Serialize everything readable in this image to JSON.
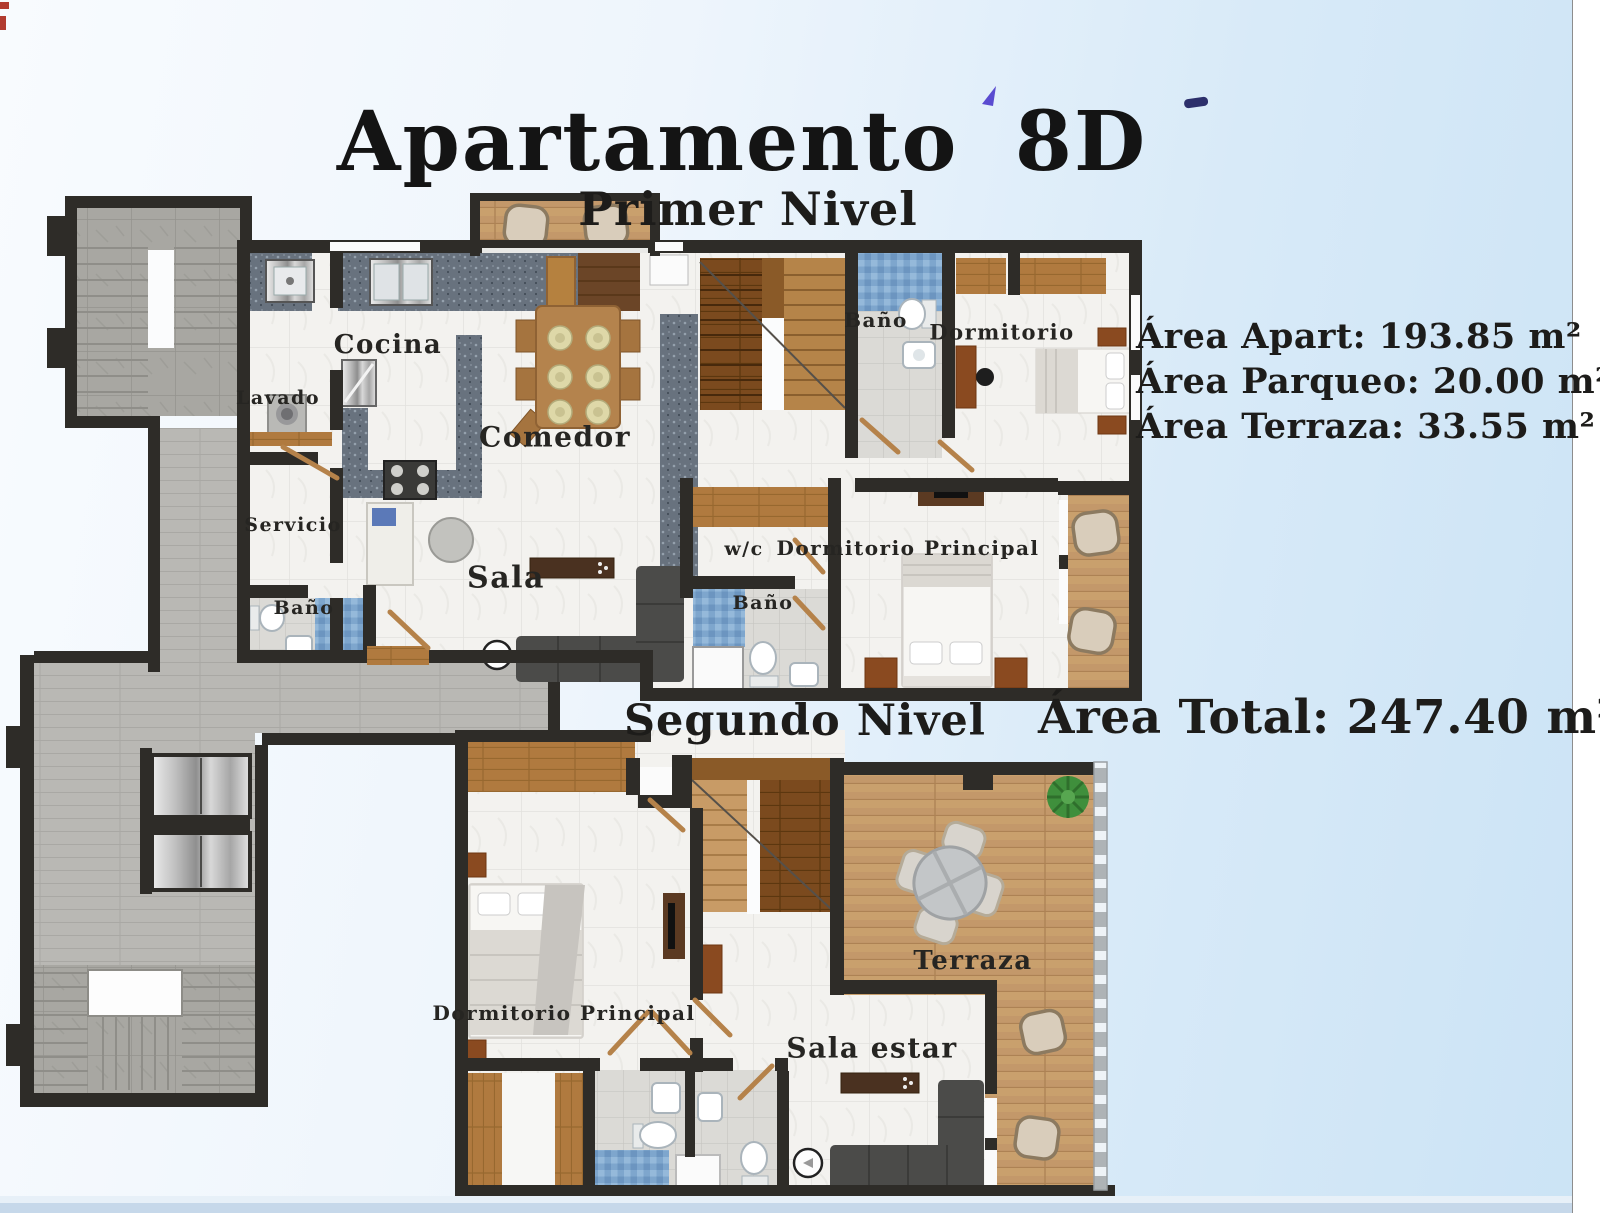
{
  "title": "Apartamento 8D",
  "level1": {
    "heading": "Primer Nivel",
    "rooms": {
      "cocina": "Cocina",
      "lavado": "Lavado",
      "servicio": "Servicio",
      "bano_servicio": "Baño",
      "sala": "Sala",
      "comedor": "Comedor",
      "bano": "Baño",
      "dormitorio": "Dormitorio",
      "wc": "w/c",
      "bano_principal": "Baño",
      "dormitorio_principal": "Dormitorio Principal"
    }
  },
  "level2": {
    "heading": "Segundo Nivel",
    "rooms": {
      "dormitorio_principal": "Dormitorio Principal",
      "sala_estar": "Sala estar",
      "terraza": "Terraza"
    }
  },
  "areas": {
    "apart": "Área Apart: 193.85 m²",
    "parqueo": "Área Parqueo: 20.00 m²",
    "terraza": "Área Terraza: 33.55 m²",
    "total": "Área Total: 247.40 m²"
  },
  "colors": {
    "wall": "#2e2c28",
    "background_left": "#f8fbfe",
    "background_right": "#cbe3f5",
    "marble_floor": "#f3f2ef",
    "wood_deck": "#c9a06d",
    "blue_tile": "#7ea6cd",
    "stone_grey": "#a8a7a2",
    "text": "#1d1c1a"
  }
}
